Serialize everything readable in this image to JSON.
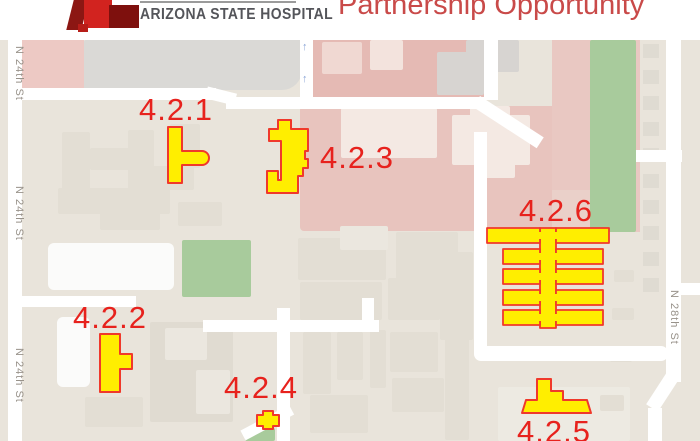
{
  "header": {
    "org_name": "ARIZONA STATE HOSPITAL",
    "title": "Partnership Opportunity"
  },
  "map": {
    "buildings": [
      {
        "id": "4.2.1"
      },
      {
        "id": "4.2.2"
      },
      {
        "id": "4.2.3"
      },
      {
        "id": "4.2.4"
      },
      {
        "id": "4.2.5"
      },
      {
        "id": "4.2.6"
      }
    ],
    "streets": [
      {
        "name": "N 24th St"
      },
      {
        "name": "N 24th St"
      },
      {
        "name": "N 24th St"
      },
      {
        "name": "N 28th St"
      }
    ],
    "icons": {
      "one_way_up": "↑"
    },
    "colors": {
      "highlight_fill": "#ffee00",
      "highlight_outline": "#f0392b",
      "label_red": "#e7221d",
      "title_red": "#c94a49",
      "campus_pink": "#e8c4be",
      "green_space": "#a8cb9c",
      "road_white": "#ffffff",
      "map_background": "#e9e4db"
    }
  }
}
